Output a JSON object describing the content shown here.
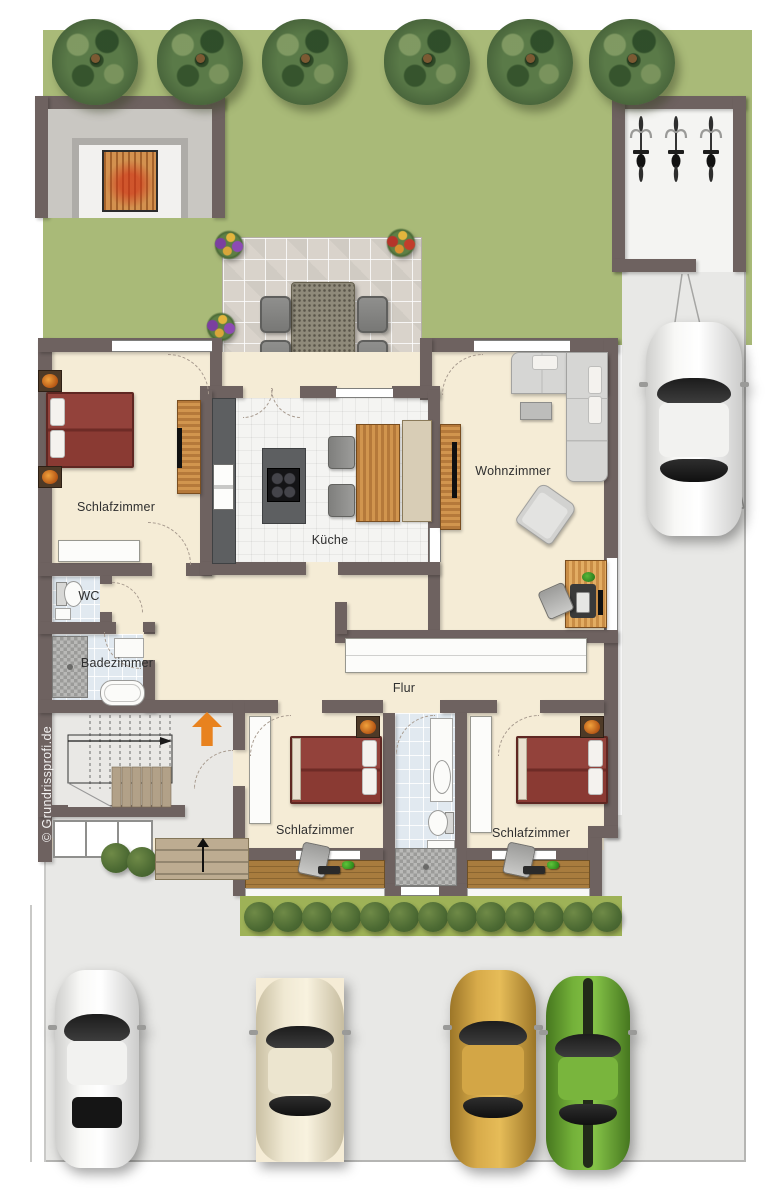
{
  "watermark": "© Grundrissprofi.de",
  "rooms": {
    "bedroom_top": "Schlafzimmer",
    "kitchen": "Küche",
    "living_room": "Wohnzimmer",
    "wc": "WC",
    "bathroom": "Badezimmer",
    "hallway": "Flur",
    "bedroom_bottom_left": "Schlafzimmer",
    "bedroom_bottom_right": "Schlafzimmer"
  },
  "exterior": {
    "trees": 6,
    "hedge_bushes": 13,
    "bicycles": 3,
    "cars_in_parking": [
      "white sports car",
      "cream sedan",
      "gold sedan",
      "green muscle car"
    ],
    "car_on_driveway": "white car"
  },
  "colors": {
    "garden_green": "#a9ba78",
    "wall_taupe": "#6e6260",
    "floor_cream": "#f5ecd6",
    "kitchen_floor": "#f4f4f2",
    "bath_tile_blue": "#e1e9f0",
    "terrace_tile": "#d9d3cb",
    "pavement_gray": "#e8e8e6",
    "bed_red": "#8d3c35",
    "wood_orange": "#c8853e",
    "balcony_wood": "#a87c3e",
    "entrance_arrow_orange": "#e8821e"
  }
}
